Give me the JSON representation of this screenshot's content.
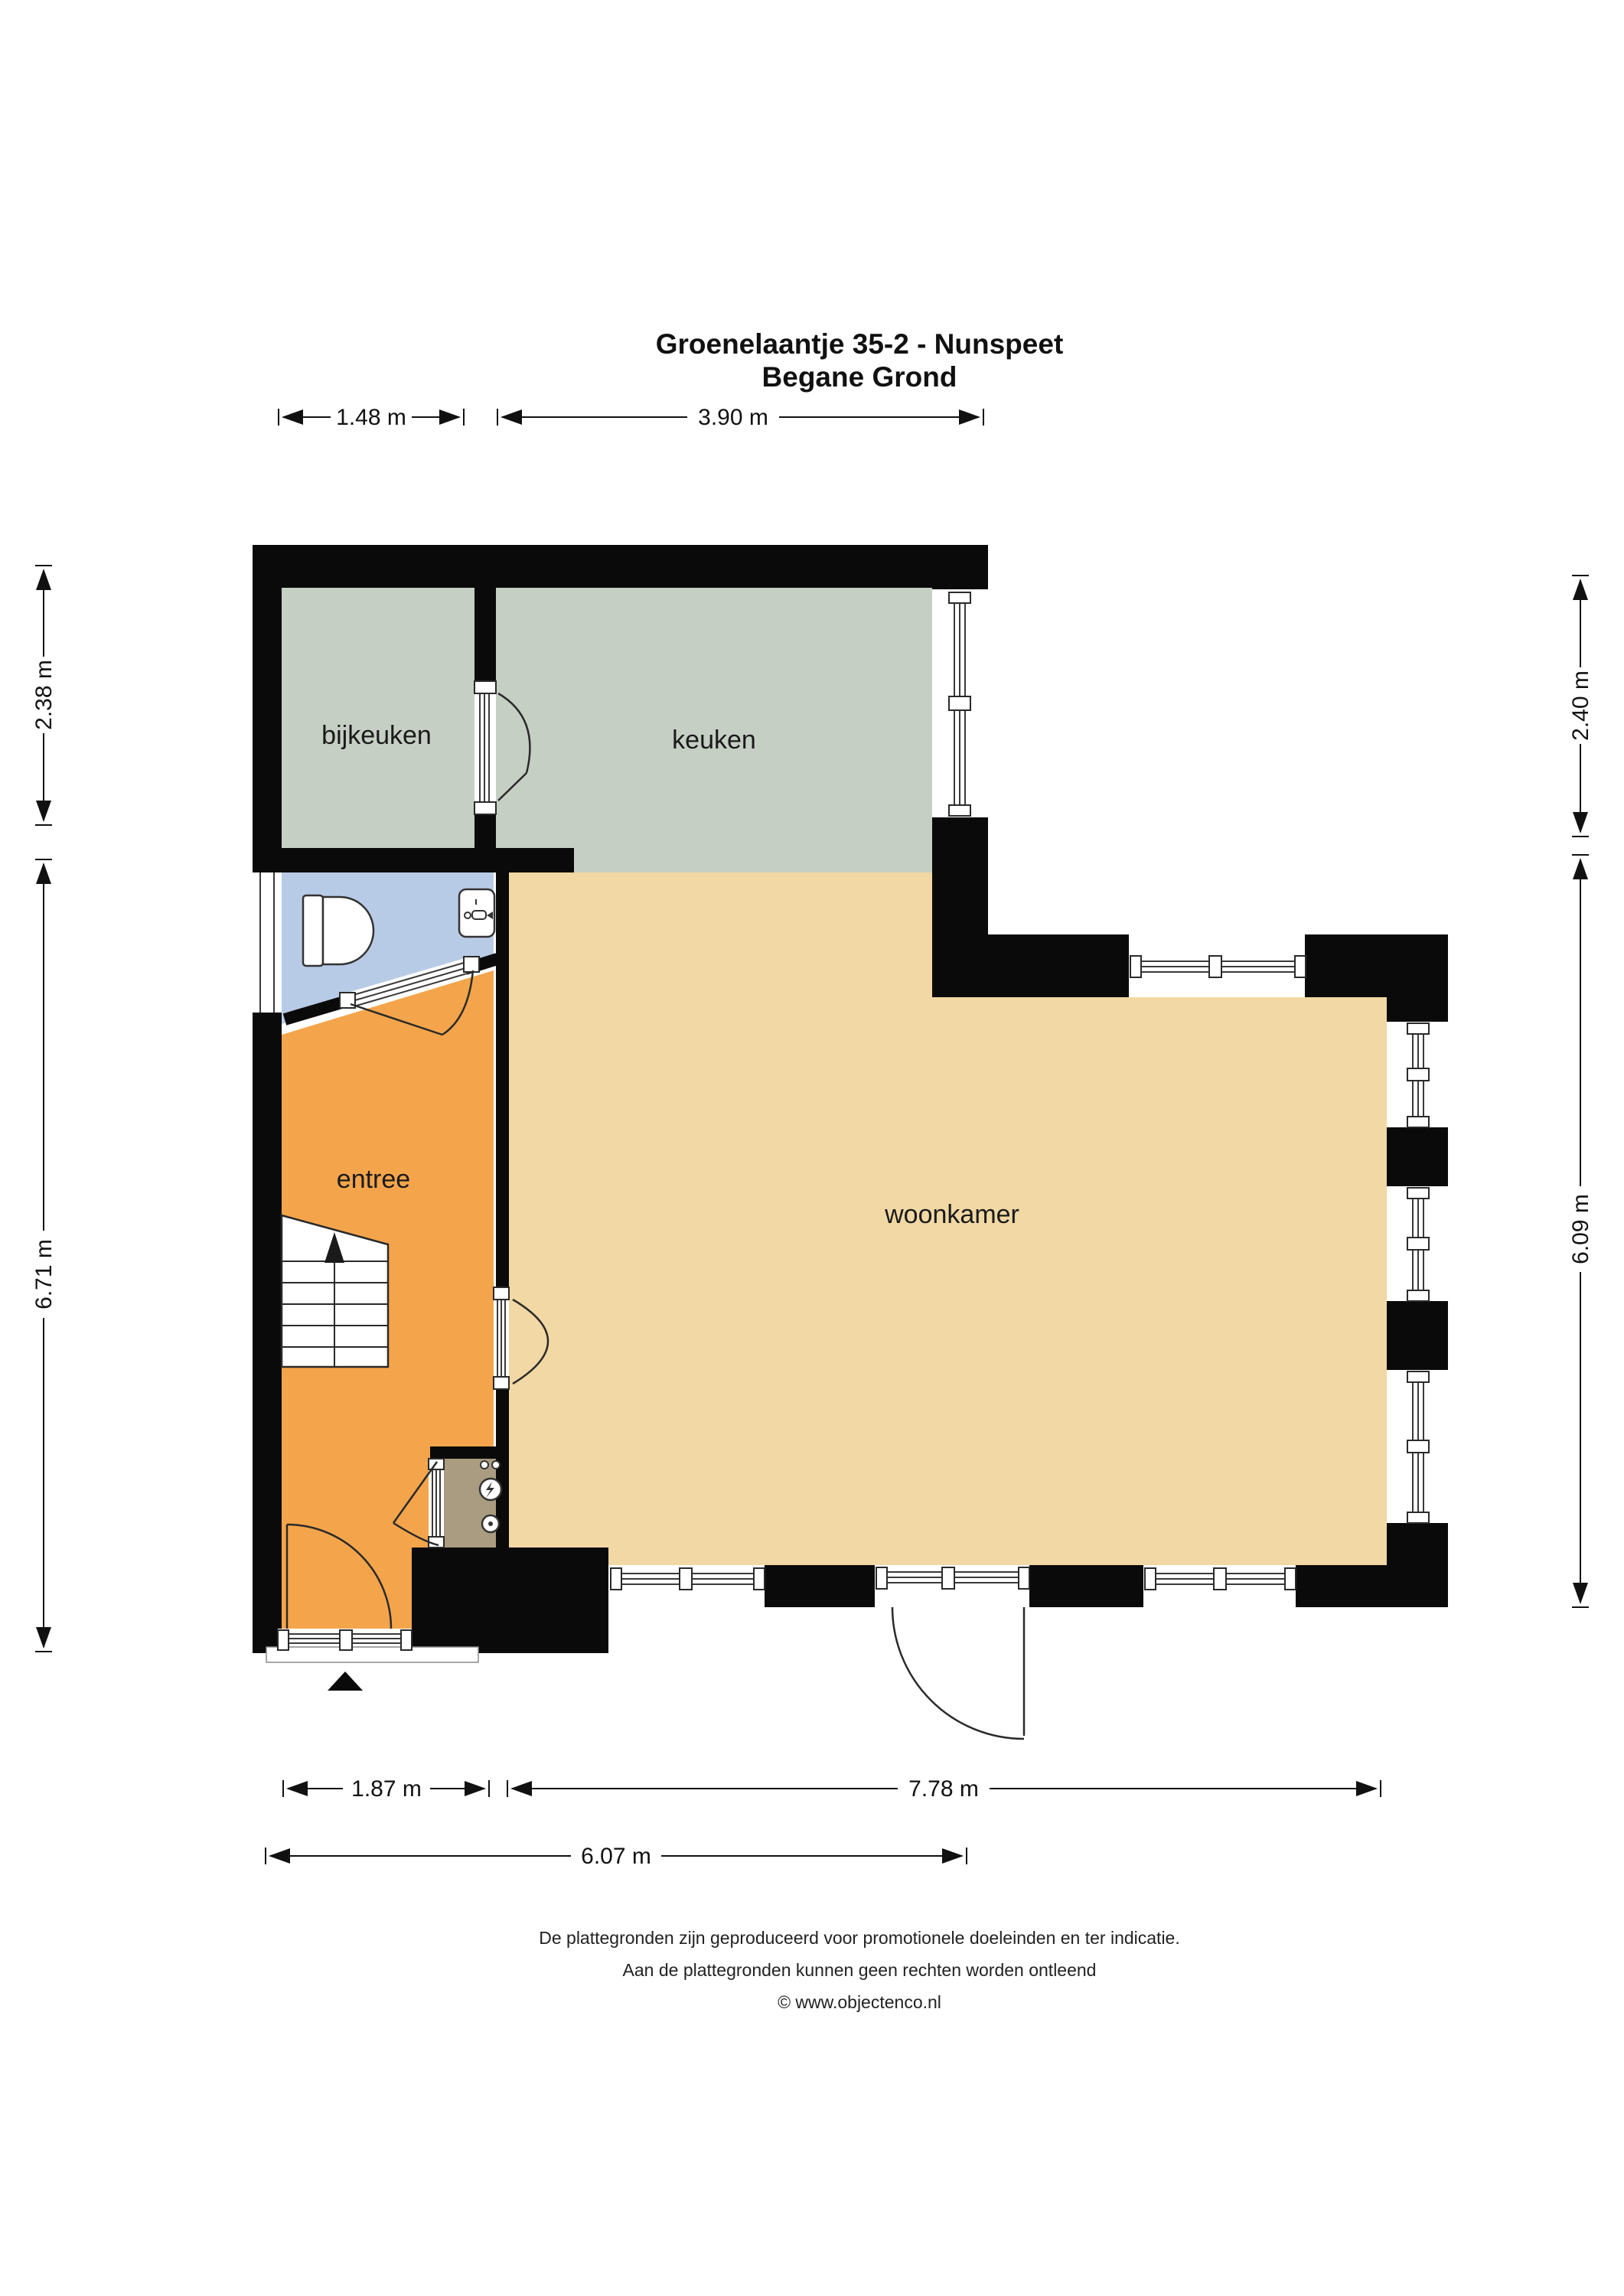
{
  "title": {
    "line1": "Groenelaantje 35-2 - Nunspeet",
    "line2": "Begane Grond"
  },
  "rooms": {
    "bijkeuken": {
      "label": "bijkeuken"
    },
    "keuken": {
      "label": "keuken"
    },
    "entree": {
      "label": "entree"
    },
    "woonkamer": {
      "label": "woonkamer"
    }
  },
  "dimensions": {
    "top": [
      "1.48 m",
      "3.90 m"
    ],
    "left": [
      "2.38 m",
      "6.71 m"
    ],
    "right": [
      "2.40 m",
      "6.09 m"
    ],
    "bottom": [
      "1.87 m",
      "7.78 m",
      "6.07 m"
    ]
  },
  "footer": {
    "line1": "De plattegronden zijn geproduceerd voor promotionele doeleinden en ter indicatie.",
    "line2": "Aan de plattegronden kunnen geen rechten worden ontleend",
    "line3": "© www.objectenco.nl"
  },
  "colors": {
    "wall": "#0a0a0a",
    "kitchen": "#c6cfc4",
    "utility": "#c6cfc4",
    "toilet": "#b8cbe6",
    "hall": "#f4a54b",
    "living": "#f2d8a4",
    "closet": "#aa9c80",
    "background": "#ffffff"
  }
}
